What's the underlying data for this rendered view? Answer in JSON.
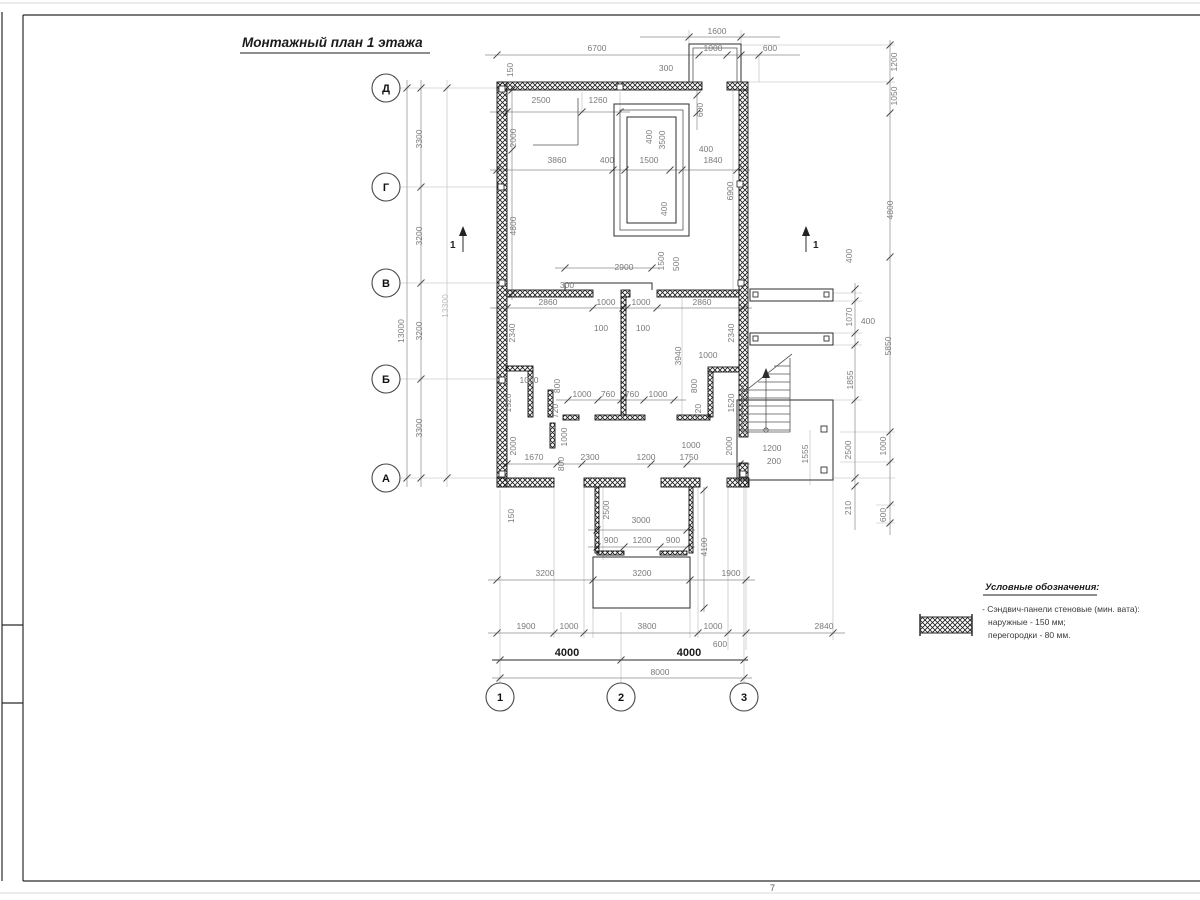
{
  "title": "Монтажный план 1 этажа",
  "legend": {
    "title": "Условные обозначения:",
    "item_line1": "- Сэндвич-панели стеновые (мин. вата):",
    "item_line2": "наружные - 150 мм;",
    "item_line3": "перегородки - 80 мм.",
    "symbol": "cross-hatched-wall-panel"
  },
  "axes": {
    "rows": [
      "Д",
      "Г",
      "В",
      "Б",
      "А"
    ],
    "cols": [
      "1",
      "2",
      "3"
    ]
  },
  "section_mark": "1",
  "sheet_mark": "7",
  "colors": {
    "wall": "#141414",
    "dim_text": "#7a7a7a",
    "dim_line": "#8c8c8c",
    "bold_dim": "#1a1a1a"
  },
  "dims": [
    "1600",
    "6700",
    "1000",
    "600",
    "300",
    "150",
    "2500",
    "1260",
    "2000",
    "600",
    "400",
    "3500",
    "400",
    "1500",
    "400",
    "1840",
    "3860",
    "400",
    "6900",
    "4800",
    "1200",
    "1050",
    "4800",
    "3300",
    "3200",
    "3200",
    "3300",
    "13000",
    "13300",
    "2900",
    "300",
    "1500",
    "500",
    "2860",
    "1000",
    "1000",
    "2860",
    "100",
    "100",
    "2340",
    "2340",
    "3940",
    "1000",
    "800",
    "800",
    "1000",
    "1520",
    "720",
    "1000",
    "760",
    "760",
    "1000",
    "720",
    "1520",
    "1000",
    "2000",
    "2000",
    "1670",
    "800",
    "2300",
    "1200",
    "1750",
    "1000",
    "400",
    "1070",
    "400",
    "1855",
    "2500",
    "1555",
    "1200",
    "200",
    "210",
    "5850",
    "1000",
    "600",
    "150",
    "2500",
    "3000",
    "4100",
    "900",
    "1200",
    "900",
    "3200",
    "3200",
    "1900",
    "1900",
    "1000",
    "3800",
    "1000",
    "2840",
    "600",
    "4000",
    "4000",
    "8000"
  ]
}
